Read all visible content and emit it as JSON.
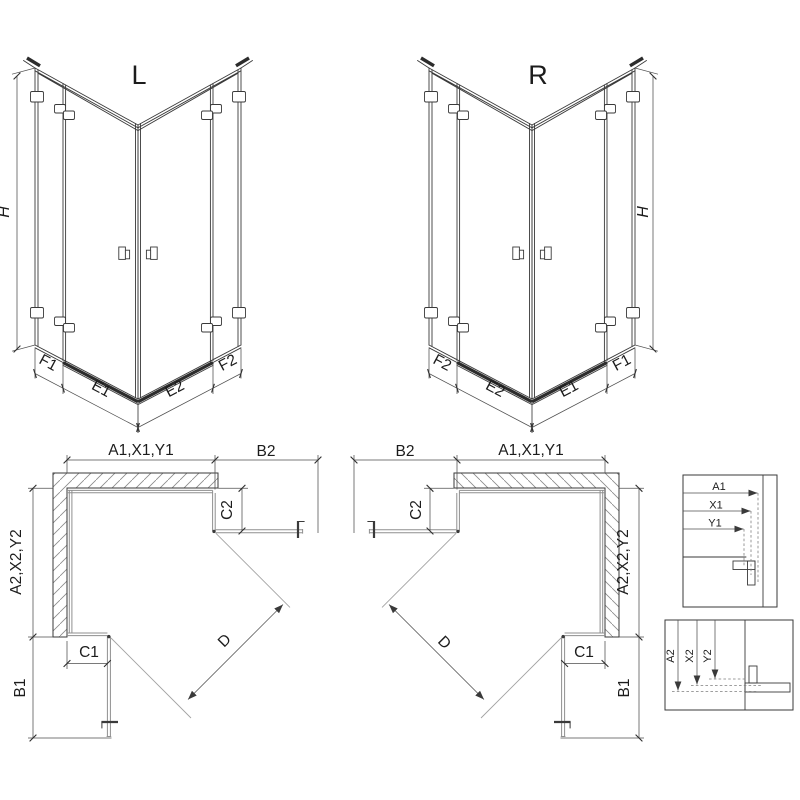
{
  "drawing": {
    "variant_left_label": "L",
    "variant_right_label": "R",
    "height_dim": "H",
    "iso_bottom_dims": {
      "f1": "F1",
      "e1": "E1",
      "e2": "E2",
      "f2": "F2"
    },
    "plan_dims": {
      "width_top": "A1,X1,Y1",
      "door_top": "B2",
      "fixed_top": "C2",
      "depth_side": "A2,X2,Y2",
      "fixed_bottom": "C1",
      "door_bottom": "B1",
      "diagonal": "D"
    },
    "detail_width_dims": [
      "A1",
      "X1",
      "Y1"
    ],
    "detail_depth_dims": [
      "A2",
      "X2",
      "Y2"
    ]
  },
  "colors": {
    "line": "#3a3a3a",
    "glass": "#8f8f8f",
    "dimension": "#4f4f4f",
    "hatch": "#8a8a8a",
    "background": "#ffffff"
  }
}
